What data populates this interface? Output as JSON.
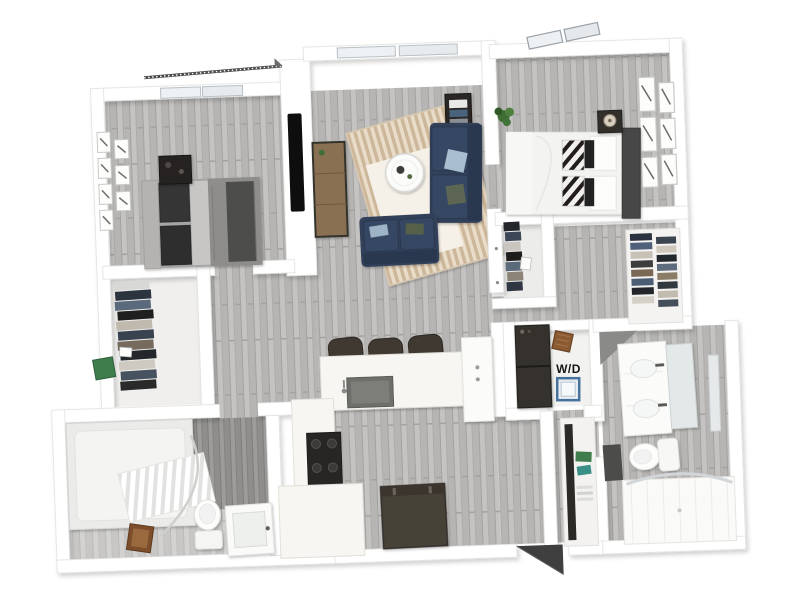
{
  "scene": {
    "type": "3d-apartment-floor-plan-render",
    "background": "#ffffff",
    "labels": {
      "washer_dryer": "W/D"
    },
    "palette": {
      "wall": "#ffffff",
      "wall_edge": "#e2e2e0",
      "wood_floor": "#bdbcba",
      "sofa_navy": "#31415a",
      "pillow_blue": "#a9bfd0",
      "pillow_olive": "#5c6652",
      "rug_tan": "#d5c0a4",
      "console_wood": "#8a6f52",
      "appliance_dark": "#35332f",
      "washer_blue": "#46729c",
      "basket_brown": "#8a5a33",
      "plant_green": "#3e6e34",
      "mat_brown": "#7c4e2b",
      "tv_black": "#0e0e0e",
      "fridge_dark": "#474239",
      "stove_dark": "#272625"
    },
    "rooms": [
      {
        "name": "bedroom-1",
        "frame_count": 7,
        "items": [
          "double-bed",
          "dark-pillows",
          "nightstand",
          "gallery-wall-frames",
          "window",
          "balcony-railing"
        ]
      },
      {
        "name": "walk-in-closet-1",
        "items": [
          "folded-clothes-stack",
          "storage-box",
          "photos"
        ]
      },
      {
        "name": "hallway-1",
        "items": [
          "doorway-to-bedroom",
          "doorway-to-bathroom"
        ]
      },
      {
        "name": "bathroom-1",
        "items": [
          "bathtub",
          "shower-curtain",
          "toilet",
          "sink-vanity",
          "bath-mat",
          "wood-accent-wall"
        ]
      },
      {
        "name": "living-room",
        "items": [
          "window",
          "tv",
          "tv-console",
          "area-rug",
          "coffee-table",
          "sofa",
          "loveseat",
          "throw-pillows",
          "side-table-with-books"
        ]
      },
      {
        "name": "kitchen",
        "bar_stools": 3,
        "items": [
          "kitchen-island",
          "island-sink",
          "bar-stools",
          "stove",
          "counter",
          "refrigerator",
          "tall-cabinet"
        ]
      },
      {
        "name": "bedroom-2",
        "frame_count": 6,
        "items": [
          "double-bed",
          "dark-headboard",
          "zebra-pillows",
          "nightstand",
          "table-lamp",
          "gallery-wall-frames",
          "window",
          "potted-plant"
        ]
      },
      {
        "name": "reach-in-closet",
        "items": [
          "hanging-clothes",
          "closet-doors"
        ]
      },
      {
        "name": "walk-in-closet-2",
        "items": [
          "shelved-folded-clothes"
        ]
      },
      {
        "name": "laundry-closet",
        "items": [
          "stacked-washer-dryer",
          "laundry-basket",
          "washer-top",
          "wd-label"
        ]
      },
      {
        "name": "hallway-2",
        "items": [
          "linen-shelves"
        ]
      },
      {
        "name": "bathroom-2",
        "items": [
          "double-sink-vanity",
          "mirror",
          "toilet",
          "walk-in-shower",
          "bath-mat"
        ]
      },
      {
        "name": "entry",
        "items": [
          "open-door"
        ]
      }
    ]
  }
}
